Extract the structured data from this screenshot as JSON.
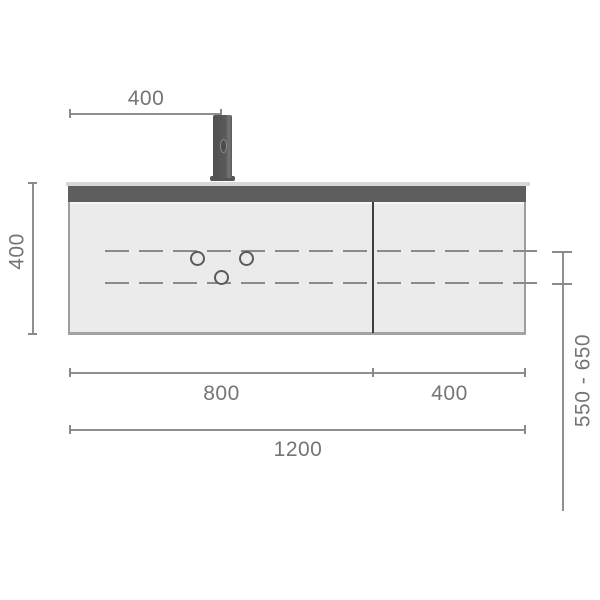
{
  "diagram": {
    "subject": "wall-hung-vanity-unit-front-elevation",
    "labels": {
      "faucet_offset": "400",
      "cabinet_height": "400",
      "install_height_range": "550 - 650",
      "left_section_width": "800",
      "right_section_width": "400",
      "total_width": "1200"
    },
    "colors": {
      "background": "#ffffff",
      "cabinet_body": "#ebebeb",
      "cabinet_top_strip": "#5e5e5e",
      "countertop_edge": "#d8d8d8",
      "cabinet_outline": "#9e9e9e",
      "door_divider": "#3e3e3e",
      "faucet": "#59595b",
      "dashed_drain_line": "#8a8a8a",
      "dimension_line": "#8f8f8f",
      "dimension_text": "#757575"
    }
  }
}
